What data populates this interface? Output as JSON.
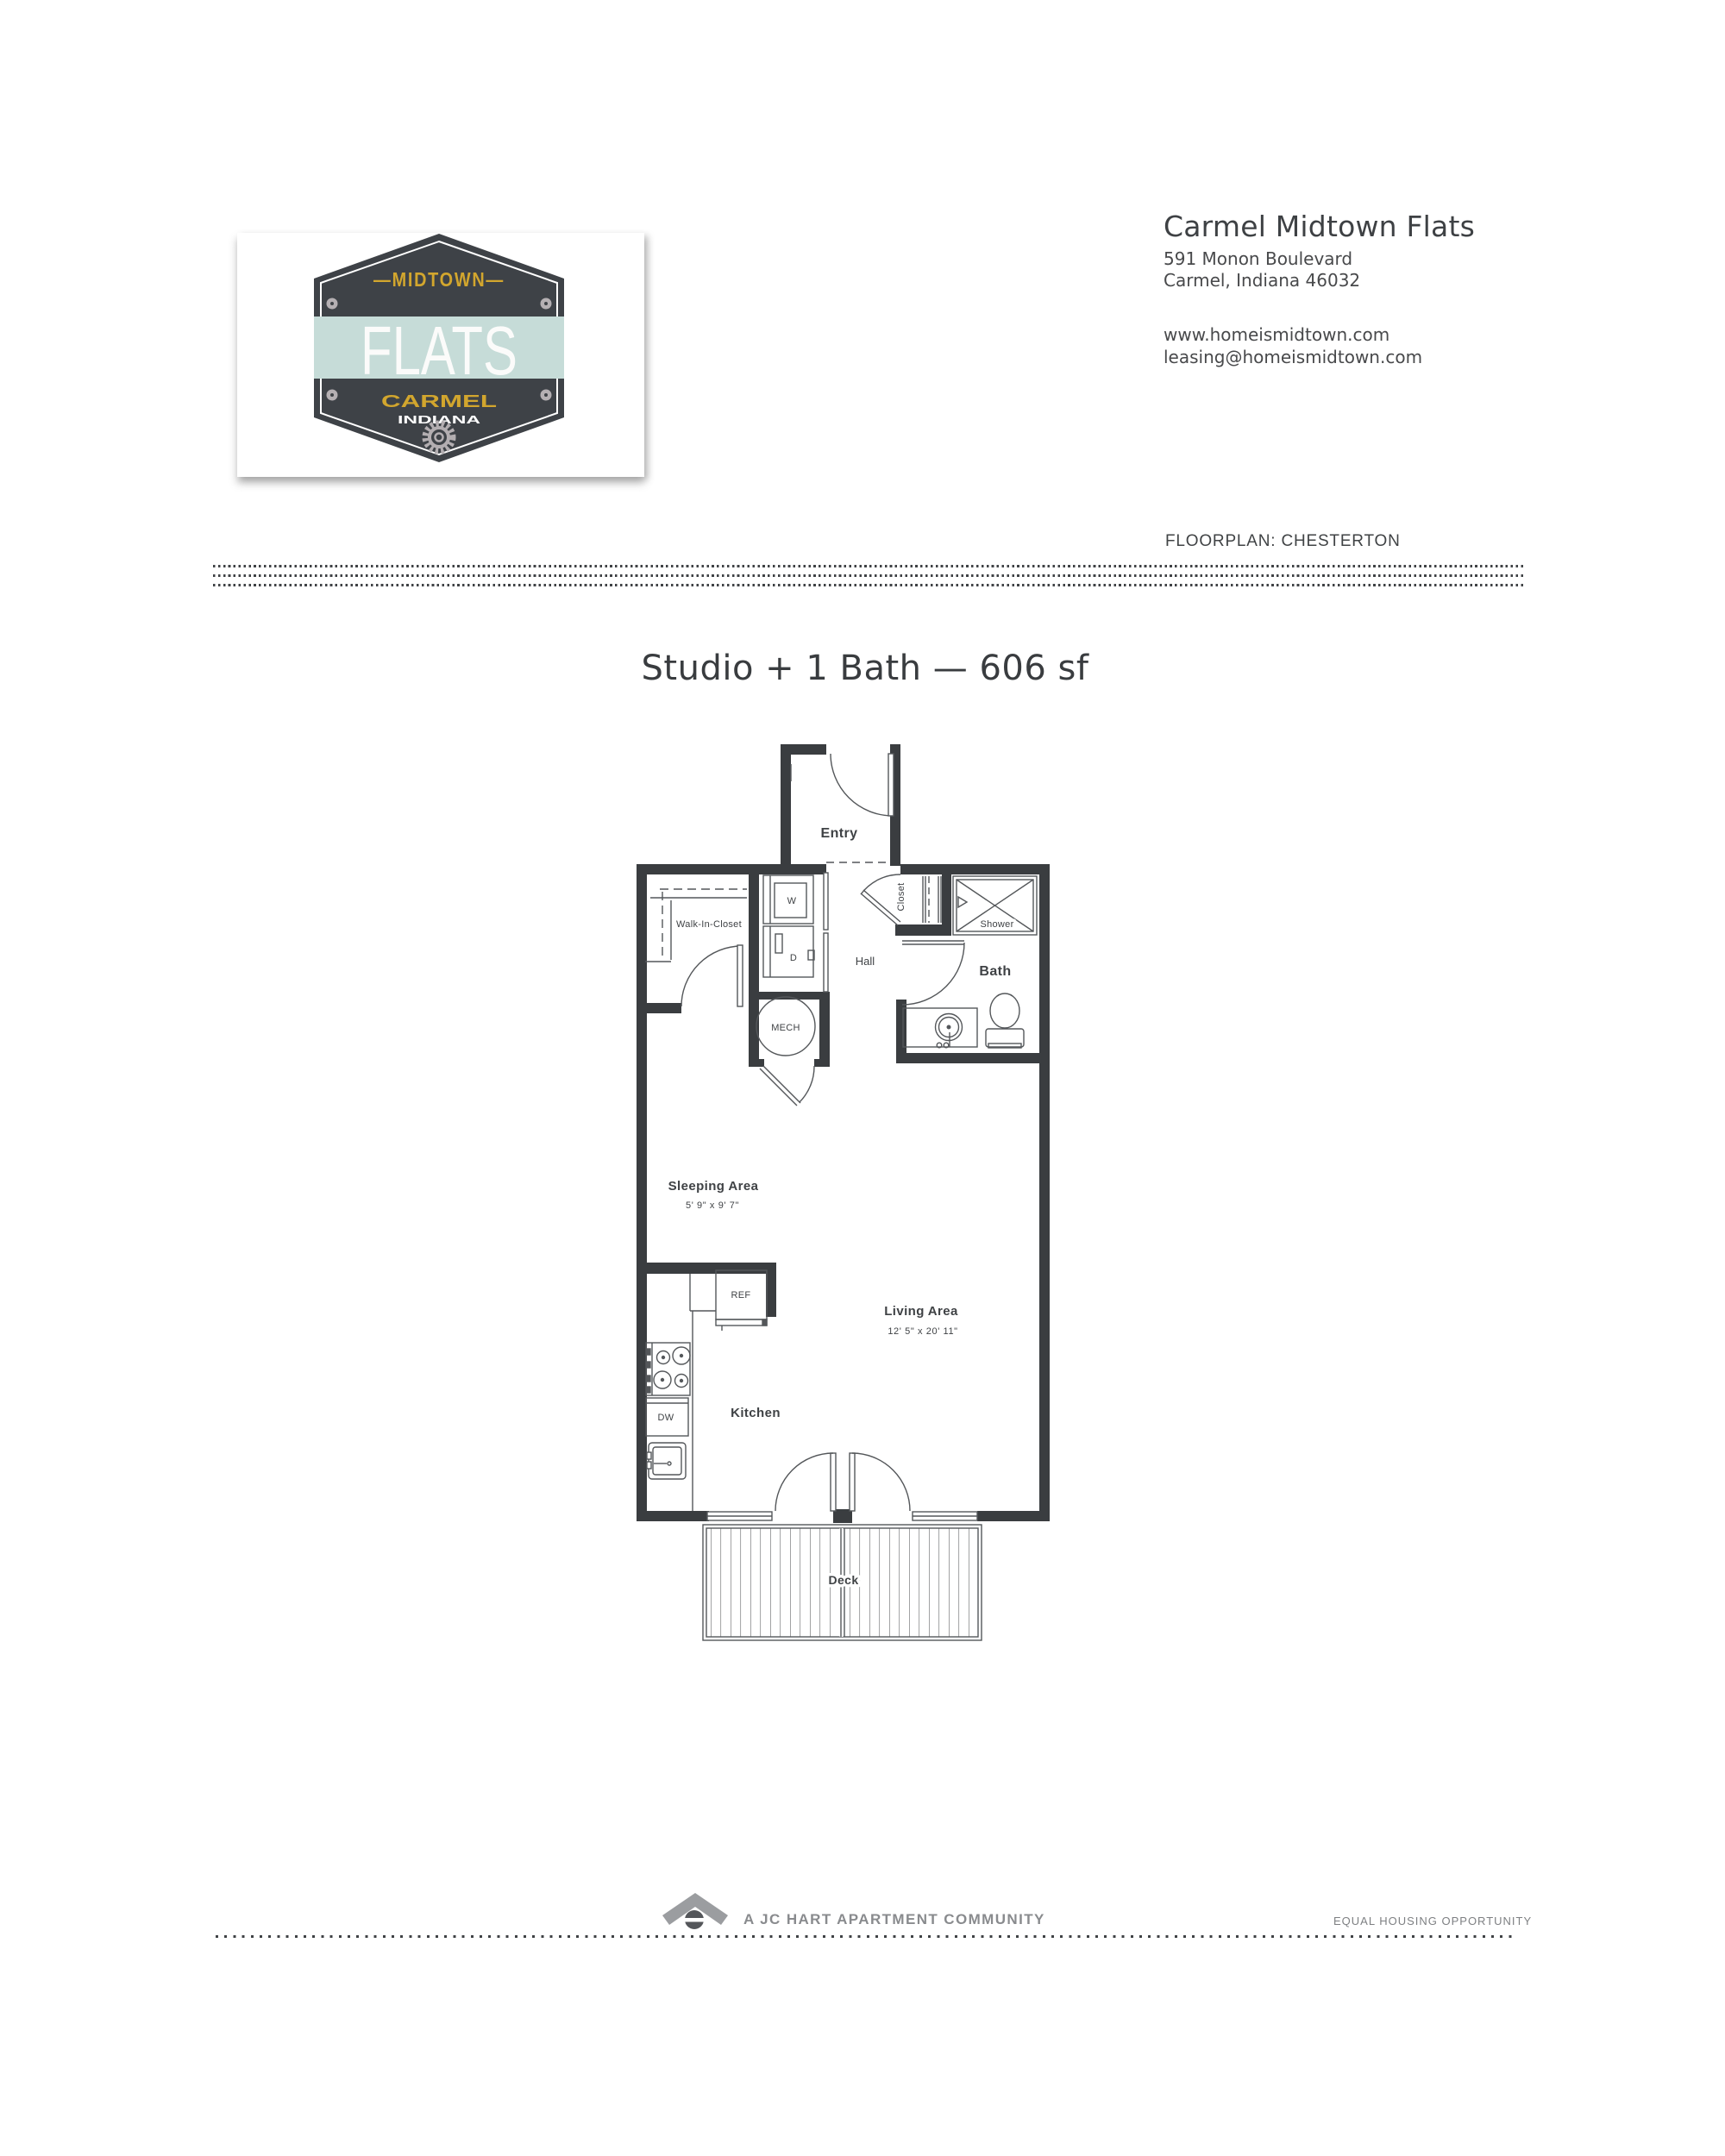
{
  "header": {
    "property_name": "Carmel Midtown Flats",
    "address_line1": "591 Monon Boulevard",
    "address_line2": "Carmel, Indiana 46032",
    "website": "www.homeismidtown.com",
    "email": "leasing@homeismidtown.com",
    "floorplan_label": "FLOORPLAN: CHESTERTON"
  },
  "logo_badge": {
    "top_word": "—MIDTOWN—",
    "name": "FLATS",
    "city": "CARMEL",
    "state": "INDIANA",
    "colors": {
      "badge_dark": "#3e4247",
      "gold": "#d2a62e",
      "mint": "#c6dcd8",
      "rivet_gray": "#b5b0b3"
    }
  },
  "title": "Studio + 1 Bath — 606 sf",
  "floorplan": {
    "wall_color": "#3a3d40",
    "line_color": "#54575a",
    "labels": {
      "entry": "Entry",
      "walk_in_closet": "Walk-In-Closet",
      "washer": "W",
      "dryer": "D",
      "mech": "MECH",
      "hall": "Hall",
      "closet": "Closet",
      "shower": "Shower",
      "bath": "Bath",
      "sleeping_area": "Sleeping Area",
      "sleeping_dims": "5' 9\" x 9' 7\"",
      "living_area": "Living Area",
      "living_dims": "12' 5\" x 20' 11\"",
      "kitchen": "Kitchen",
      "fridge": "REF",
      "dishwasher": "DW",
      "deck": "Deck"
    }
  },
  "footer": {
    "community_text": "A JC HART APARTMENT COMMUNITY",
    "eho_text": "EQUAL HOUSING OPPORTUNITY"
  }
}
